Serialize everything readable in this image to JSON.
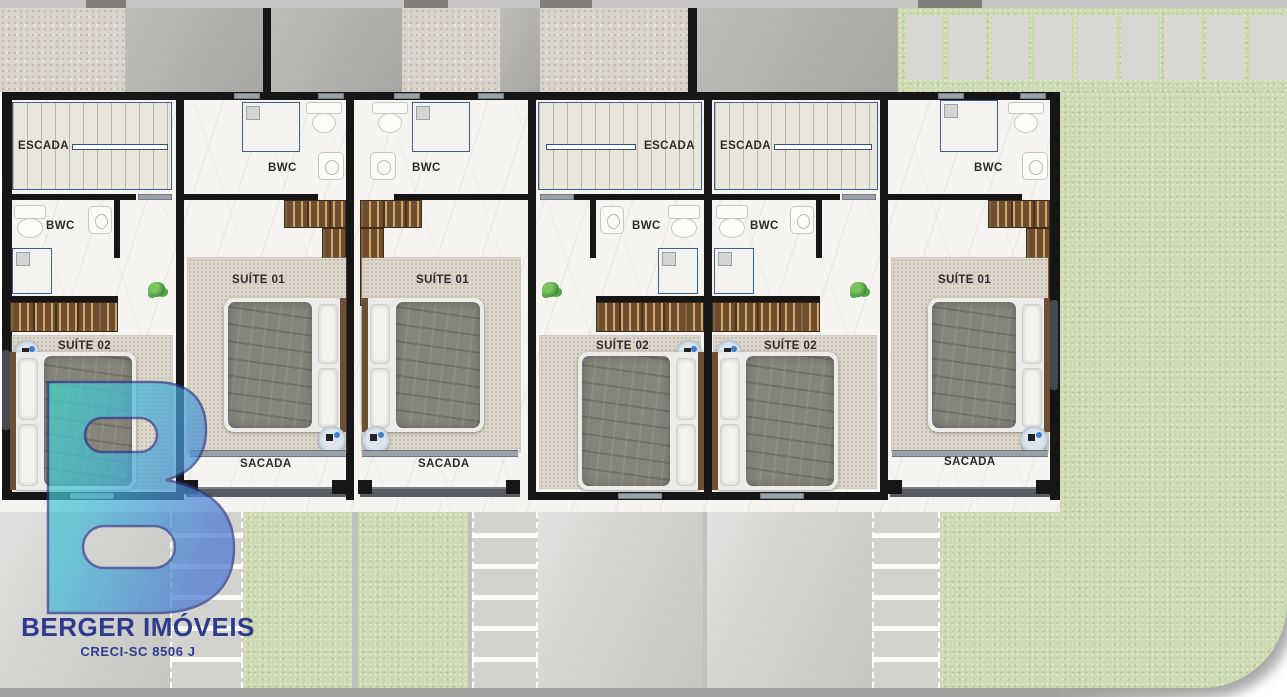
{
  "branding": {
    "agency_name": "BERGER IMÓVEIS",
    "license": "CRECI-SC 8506 J",
    "logo_teal": "#43d8c8",
    "logo_blue": "#4a77d2",
    "text_navy": "#2e3a8e"
  },
  "room_labels": {
    "stairs": "ESCADA",
    "bathroom": "BWC",
    "suite_01": "SUÍTE 01",
    "suite_02": "SUÍTE 02",
    "balcony": "SACADA"
  },
  "units": [
    {
      "name": "unit-1",
      "rooms": [
        "ESCADA",
        "BWC",
        "SUÍTE 02"
      ]
    },
    {
      "name": "unit-2",
      "rooms": [
        "BWC",
        "SUÍTE 01",
        "SACADA"
      ]
    },
    {
      "name": "unit-3",
      "rooms": [
        "BWC",
        "SUÍTE 01",
        "SACADA"
      ]
    },
    {
      "name": "unit-4",
      "rooms": [
        "ESCADA",
        "BWC",
        "SUÍTE 02"
      ]
    },
    {
      "name": "unit-5",
      "rooms": [
        "ESCADA",
        "BWC",
        "SUÍTE 02"
      ]
    },
    {
      "name": "unit-6",
      "rooms": [
        "BWC",
        "SUÍTE 01",
        "SACADA"
      ]
    }
  ],
  "colors": {
    "wall": "#161616",
    "marble_floor": "#f5f4f1",
    "stair_floor": "#e9e6db",
    "wood": "#6f4e2f",
    "rug": "#ddd6ca",
    "bed_blanket": "#85857c",
    "lawn": "#cdd9b0",
    "concrete_light": "#d2d3cf",
    "concrete_dark": "#b3b2ae",
    "paver": "#d7d8d3",
    "handrail_navy": "#34517d"
  }
}
